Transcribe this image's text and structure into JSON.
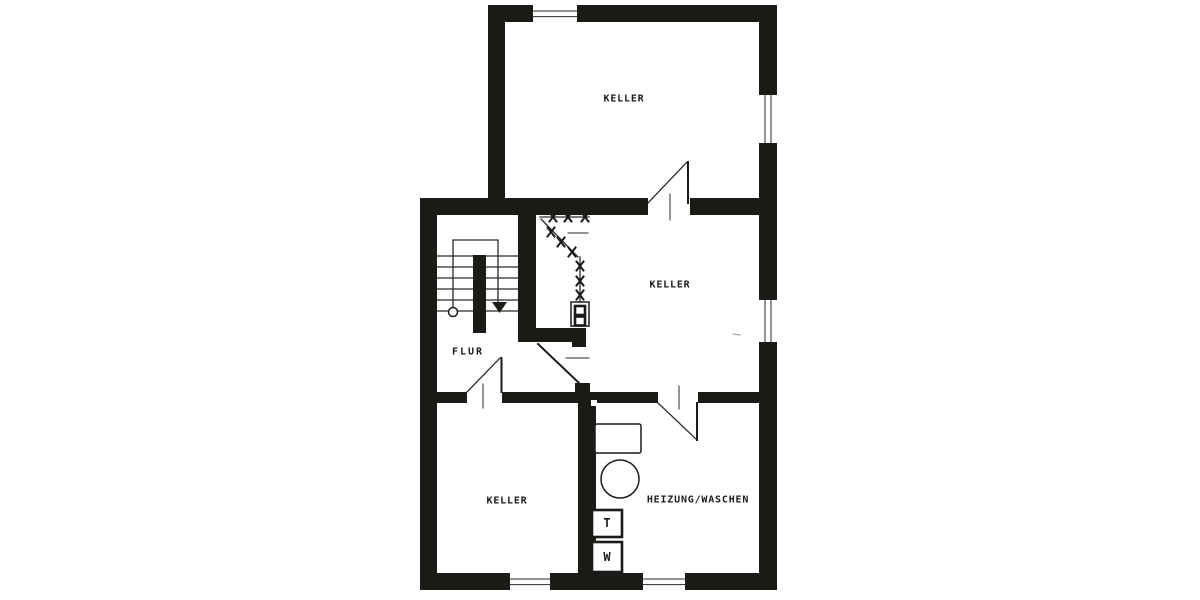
{
  "colors": {
    "wall": "#1b1b18",
    "line": "#2a2a26",
    "bg": "#ffffff",
    "text": "#1b1b18"
  },
  "rooms": {
    "keller_top": {
      "label": "KELLER"
    },
    "keller_middle": {
      "label": "KELLER"
    },
    "keller_bottom": {
      "label": "KELLER"
    },
    "flur": {
      "label": "FLUR"
    },
    "heizung_waschen": {
      "label": "HEIZUNG/WASCHEN"
    }
  },
  "appliances": {
    "t_unit": {
      "label": "T"
    },
    "w_unit": {
      "label": "W"
    }
  }
}
